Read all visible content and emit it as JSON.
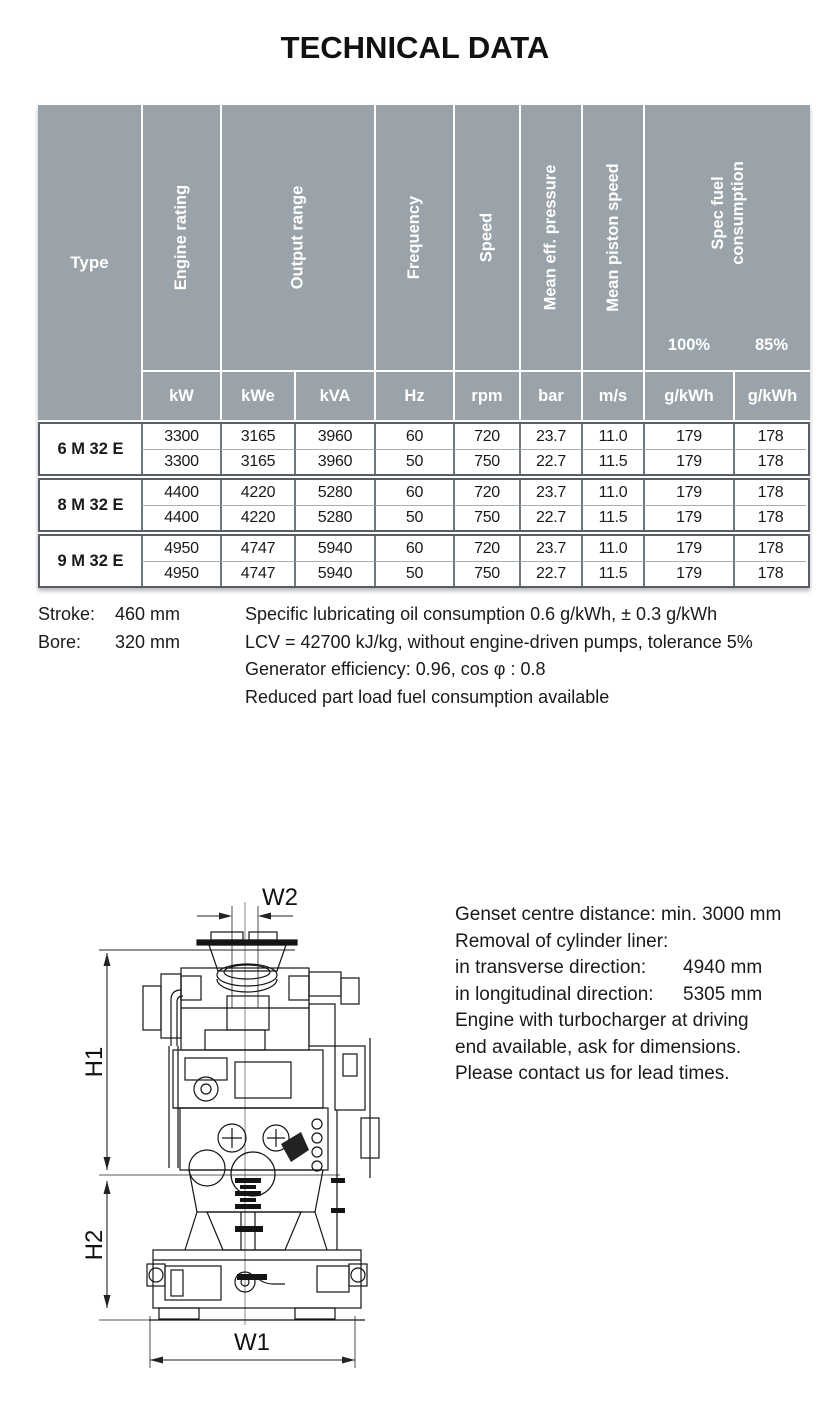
{
  "title": "TECHNICAL DATA",
  "colors": {
    "header_gray": "#9aa3a9",
    "group_border": "#575e66",
    "text": "#1a1a1a"
  },
  "table": {
    "type_label": "Type",
    "vertical_labels": {
      "engine_rating": "Engine rating",
      "output_range": "Output range",
      "frequency": "Frequency",
      "speed": "Speed",
      "mean_eff_pressure": "Mean eff. pressure",
      "mean_piston_speed": "Mean piston speed",
      "spec_fuel_line1": "Spec fuel",
      "spec_fuel_line2": "consumption"
    },
    "load_points": {
      "full": "100%",
      "part": "85%"
    },
    "units": [
      "kW",
      "kWe",
      "kVA",
      "Hz",
      "rpm",
      "bar",
      "m/s",
      "g/kWh",
      "g/kWh"
    ],
    "groups": [
      {
        "type": "6 M 32 E",
        "rows": [
          [
            "3300",
            "3165",
            "3960",
            "60",
            "720",
            "23.7",
            "11.0",
            "179",
            "178"
          ],
          [
            "3300",
            "3165",
            "3960",
            "50",
            "750",
            "22.7",
            "11.5",
            "179",
            "178"
          ]
        ]
      },
      {
        "type": "8 M 32 E",
        "rows": [
          [
            "4400",
            "4220",
            "5280",
            "60",
            "720",
            "23.7",
            "11.0",
            "179",
            "178"
          ],
          [
            "4400",
            "4220",
            "5280",
            "50",
            "750",
            "22.7",
            "11.5",
            "179",
            "178"
          ]
        ]
      },
      {
        "type": "9 M 32 E",
        "rows": [
          [
            "4950",
            "4747",
            "5940",
            "60",
            "720",
            "23.7",
            "11.0",
            "179",
            "178"
          ],
          [
            "4950",
            "4747",
            "5940",
            "50",
            "750",
            "22.7",
            "11.5",
            "179",
            "178"
          ]
        ]
      }
    ]
  },
  "notes": {
    "stroke_label": "Stroke:",
    "stroke_value": "460 mm",
    "bore_label": "Bore:",
    "bore_value": "320 mm",
    "lines": [
      "Specific lubricating oil consumption 0.6 g/kWh, ± 0.3 g/kWh",
      "LCV = 42700 kJ/kg, without engine-driven pumps, tolerance 5%",
      "Generator efficiency: 0.96, cos φ : 0.8",
      "Reduced part load fuel consumption available"
    ]
  },
  "figure": {
    "dimensions": {
      "h1": "H1",
      "h2": "H2",
      "w1": "W1",
      "w2": "W2"
    }
  },
  "side_text": {
    "genset": "Genset centre distance: min. 3000 mm",
    "removal_title": "Removal of cylinder liner:",
    "removal_rows": [
      {
        "label": "in transverse direction:",
        "value": "4940 mm"
      },
      {
        "label": "in longitudinal direction:",
        "value": "5305 mm"
      }
    ],
    "turbo_lines": [
      "Engine with turbocharger at driving",
      "end available, ask for dimensions."
    ],
    "contact": "Please contact us for lead times."
  }
}
